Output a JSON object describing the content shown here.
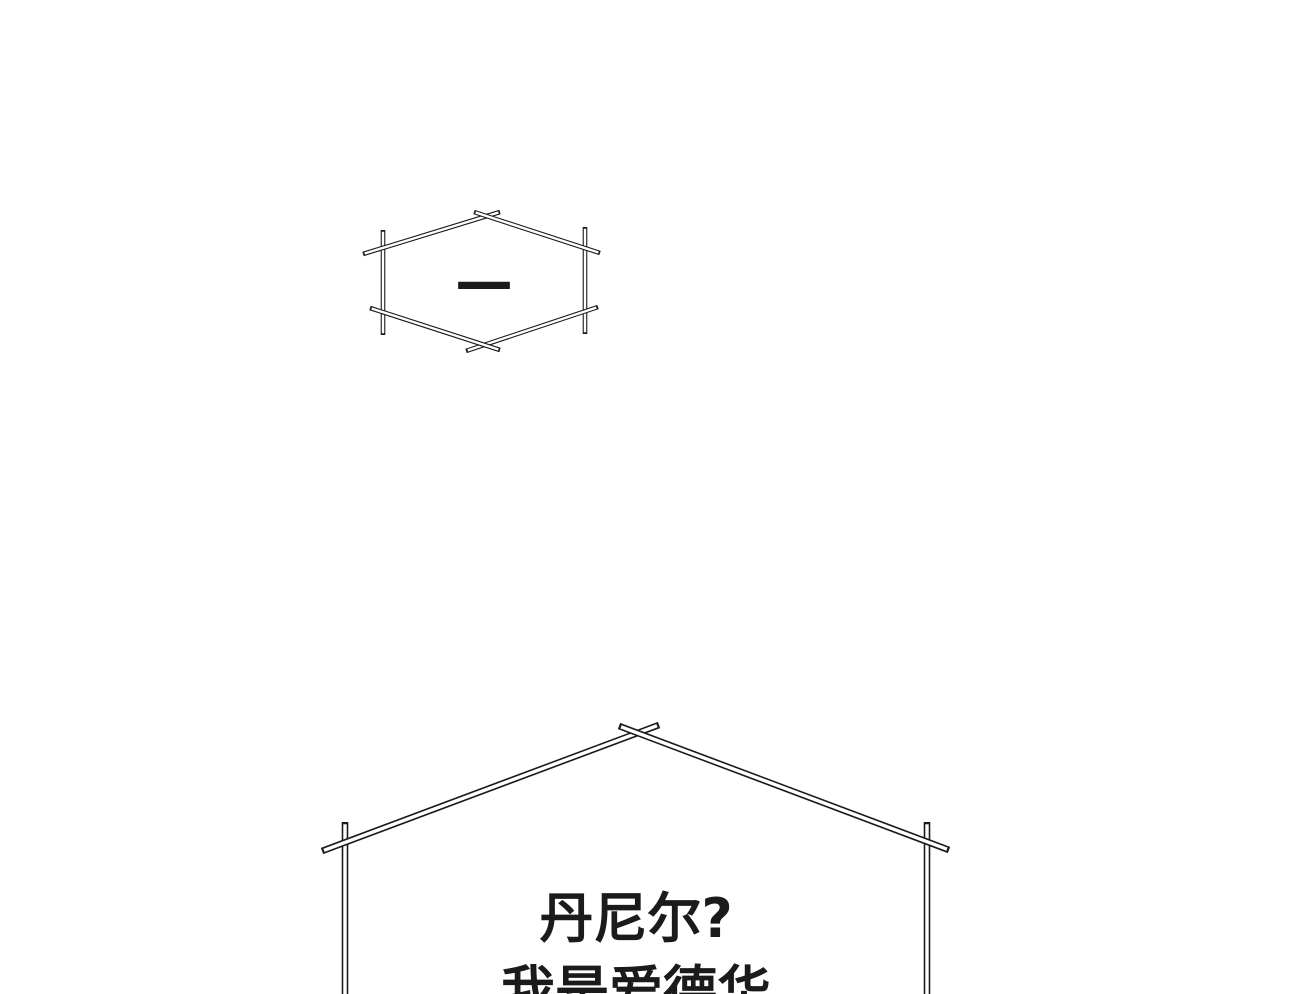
{
  "page": {
    "background_color": "#ffffff",
    "ink_color": "#1b1b1b"
  },
  "bubbles": {
    "small": {
      "dash": "—"
    },
    "large": {
      "line1": "丹尼尔?",
      "line2": "我是爱德华"
    }
  }
}
